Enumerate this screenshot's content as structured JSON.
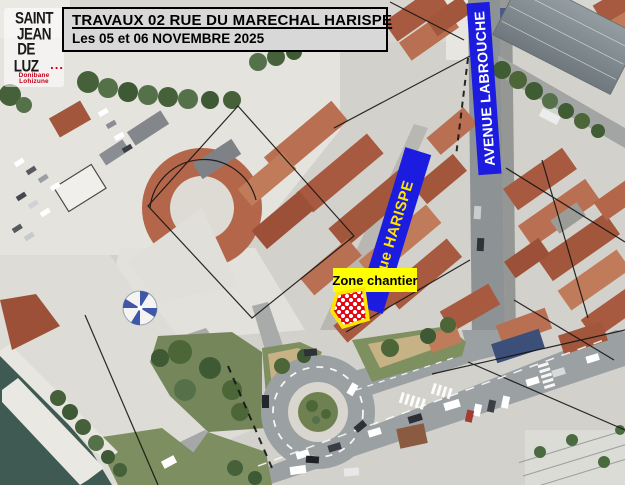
{
  "logo": {
    "line1": "SAINT",
    "line2": "JEAN",
    "line3": "DE LUZ",
    "dots": "...",
    "subtitle": "Donibane Lohizune"
  },
  "title_box": {
    "title": "TRAVAUX 02 RUE DU MARECHAL HARISPE",
    "subtitle": "Les 05 et 06 NOVEMBRE 2025"
  },
  "street_labels": [
    {
      "text": "Rue HARISPE",
      "text_color": "#ffe600",
      "bg_color": "#1c1ce0"
    },
    {
      "text": "AVENUE LABROUCHE",
      "text_color": "#ffffff",
      "bg_color": "#1c1ce0"
    }
  ],
  "zone": {
    "label": "Zone chantier",
    "label_bg_color": "#ffff00",
    "label_text_color": "#000000",
    "marker_style": "red-white-checker",
    "marker_border_color": "#ffe600",
    "marker_fill_color": "#e30613"
  },
  "colors": {
    "label_blue": "#1c1ce0",
    "harispe_text": "#ffe600",
    "labrouche_text": "#ffffff",
    "zone_yellow": "#ffff00",
    "checker_red": "#e30613",
    "marker_border": "#ffe600",
    "title_bg": "#d8d8d8",
    "title_border": "#000000",
    "logo_text": "#1a1a1a",
    "logo_red": "#c10016"
  }
}
